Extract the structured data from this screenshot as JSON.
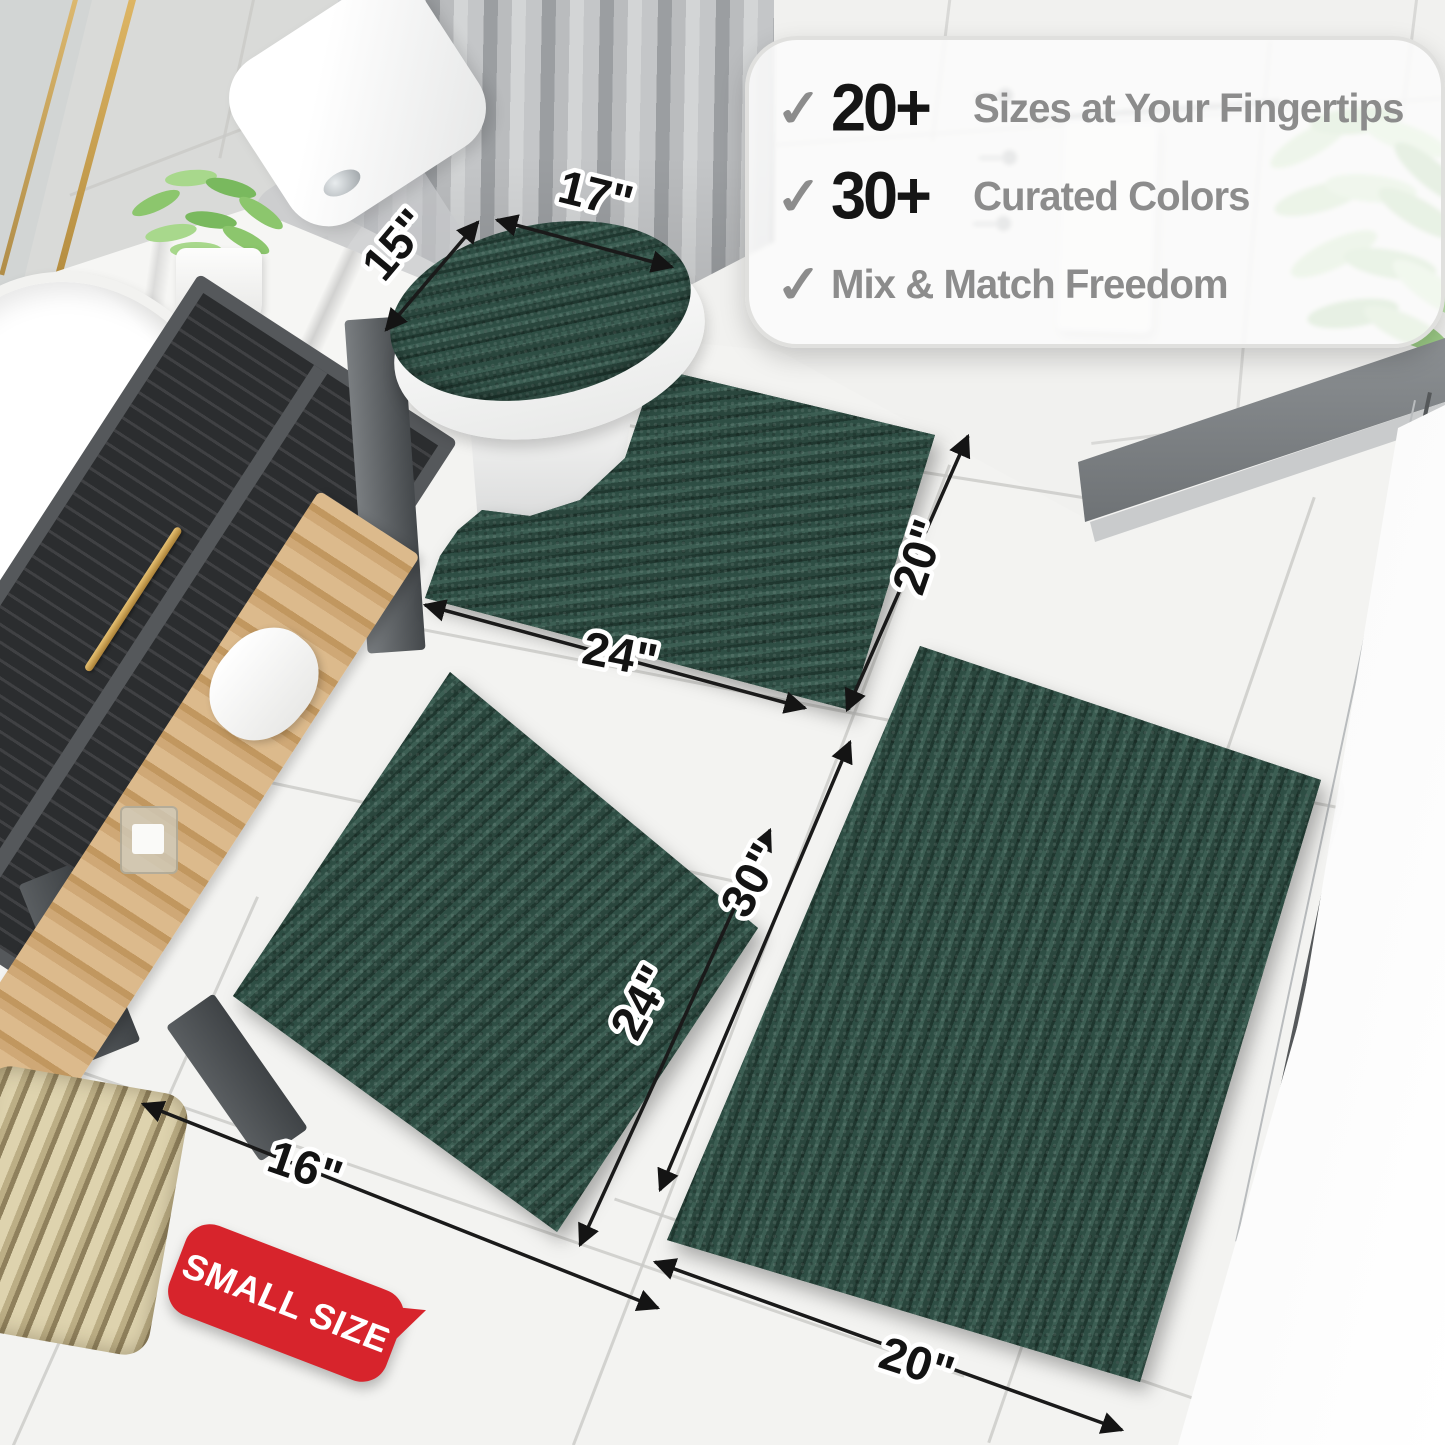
{
  "callout": {
    "items": [
      {
        "check": "✓",
        "number": "20+",
        "text": "Sizes at Your Fingertips"
      },
      {
        "check": "✓",
        "number": "30+",
        "text": "Curated Colors"
      },
      {
        "check": "✓",
        "number": "",
        "text": "Mix & Match Freedom"
      }
    ]
  },
  "dimensions": {
    "lid_depth": "15\"",
    "lid_width": "17\"",
    "contour_width": "24\"",
    "contour_depth": "20\"",
    "small_length": "24\"",
    "small_width": "16\"",
    "large_length": "30\"",
    "large_width": "20\""
  },
  "badge": {
    "label": "SMALL SIZE"
  },
  "colors": {
    "mat_green": "#2C4A41",
    "badge_red": "#D7242C",
    "accent_gold": "#C9A254",
    "check_gray": "#8C8C8C",
    "number_black": "#151515"
  }
}
